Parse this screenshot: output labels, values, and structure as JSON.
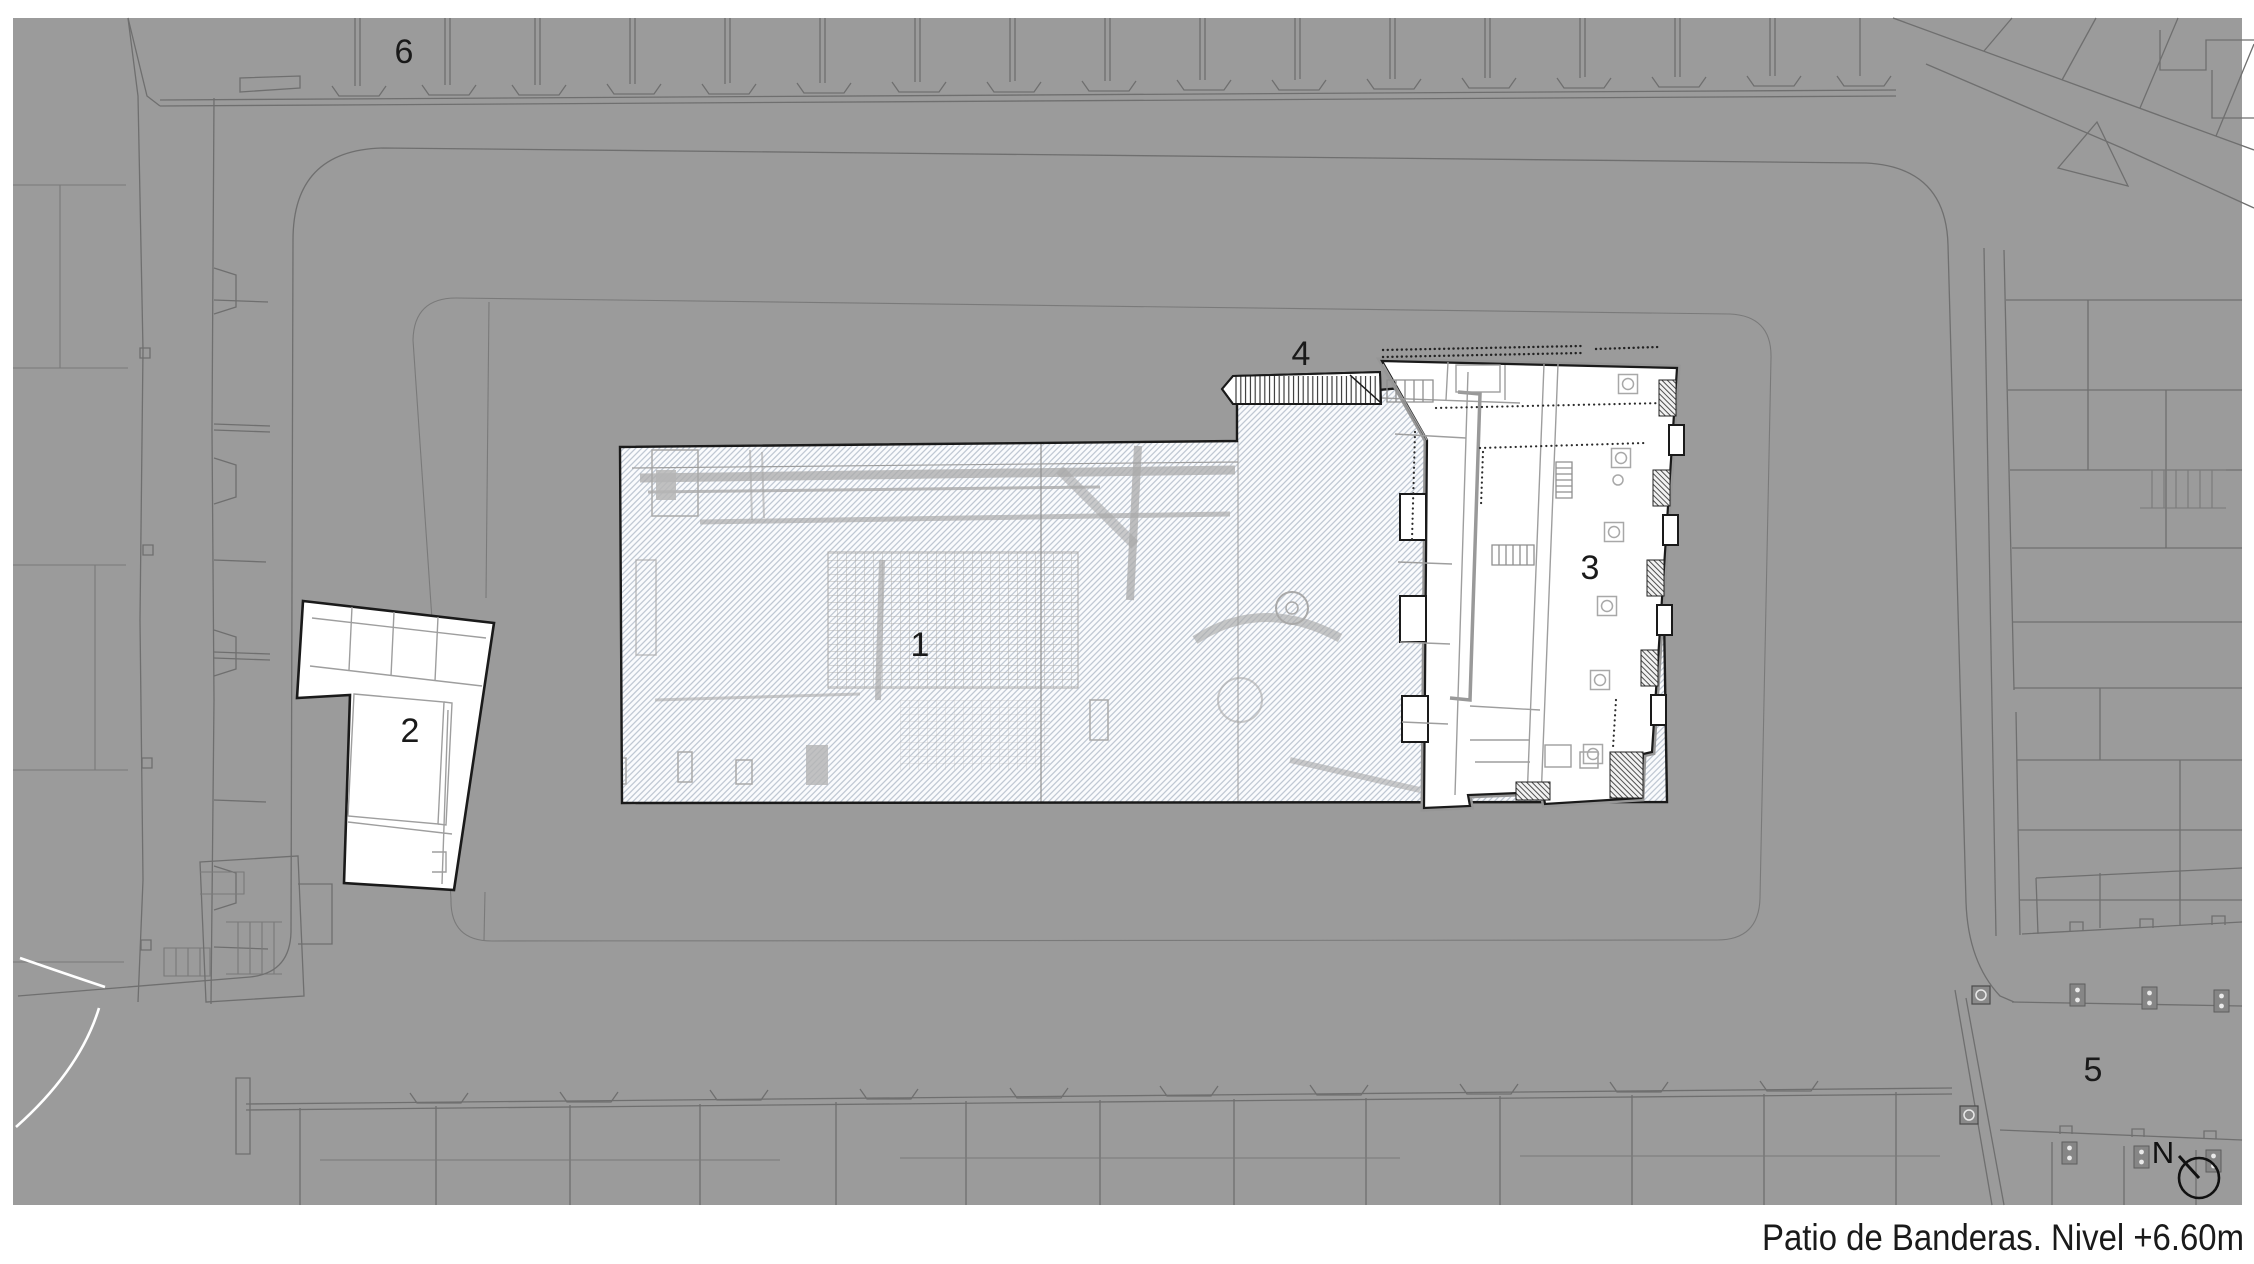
{
  "title": "Patio de Banderas. Nivel +6.60m",
  "compass": {
    "letter": "N"
  },
  "area_labels": [
    "1",
    "2",
    "3",
    "4",
    "5",
    "6"
  ],
  "colors": {
    "page_bg": "#ffffff",
    "map_bg": "#9b9b9b",
    "context_line": "#6f6f6f",
    "ink": "#1a1a1a",
    "excavation_hatch": "#b7c0cd",
    "excavation_base": "#fafbfd",
    "ruin_gray": "#a9a9a9",
    "building_fill": "#ffffff",
    "poche_gray": "#969696"
  }
}
